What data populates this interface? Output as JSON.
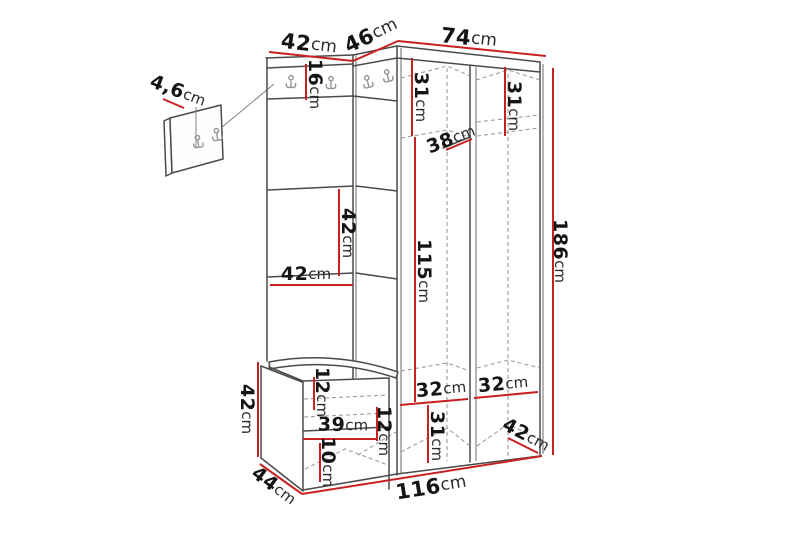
{
  "title": "hallway-furniture-set-dimension-diagram",
  "colors": {
    "dimension_line": "#c92121",
    "outline": "#4b4b4b",
    "dashed": "#9c9c9c",
    "label_text": "#141414",
    "background": "#ffffff"
  },
  "icons": {
    "coat_hook": "double-prong-wall-hook"
  },
  "dimensions": {
    "top_left_width": {
      "value": "42",
      "unit": "cm"
    },
    "corner_width": {
      "value": "46",
      "unit": "cm"
    },
    "top_right_width": {
      "value": "74",
      "unit": "cm"
    },
    "panel_thickness": {
      "value": "4,6",
      "unit": "cm"
    },
    "hook_rail_height": {
      "value": "16",
      "unit": "cm"
    },
    "left_top_compartment": {
      "value": "31",
      "unit": "cm"
    },
    "right_top_compartment": {
      "value": "31",
      "unit": "cm"
    },
    "shelf_depth": {
      "value": "38",
      "unit": "cm"
    },
    "panel_section_height": {
      "value": "42",
      "unit": "cm"
    },
    "panel_section_width": {
      "value": "42",
      "unit": "cm"
    },
    "hanging_space_height": {
      "value": "115",
      "unit": "cm"
    },
    "total_height": {
      "value": "186",
      "unit": "cm"
    },
    "bench_height": {
      "value": "42",
      "unit": "cm"
    },
    "bench_top_gap": {
      "value": "12",
      "unit": "cm"
    },
    "bench_shelf_width": {
      "value": "39",
      "unit": "cm"
    },
    "bench_mid_gap": {
      "value": "12",
      "unit": "cm"
    },
    "bench_bottom_gap": {
      "value": "10",
      "unit": "cm"
    },
    "bench_depth": {
      "value": "44",
      "unit": "cm"
    },
    "bottom_left_compartment": {
      "value": "32",
      "unit": "cm"
    },
    "bottom_right_compartment": {
      "value": "32",
      "unit": "cm"
    },
    "bottom_compartment_height": {
      "value": "31",
      "unit": "cm"
    },
    "wardrobe_depth": {
      "value": "42",
      "unit": "cm"
    },
    "total_width": {
      "value": "116",
      "unit": "cm"
    }
  }
}
